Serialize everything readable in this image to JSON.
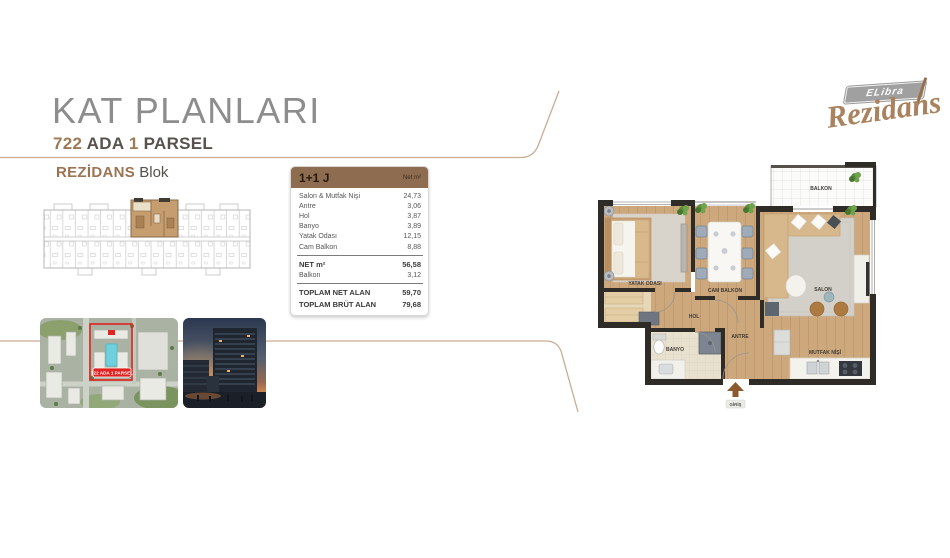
{
  "slide": {
    "title": "KAT PLANLARI",
    "parcel": {
      "num1": "722",
      "word1": "ADA",
      "num2": "1",
      "word2": "PARSEL"
    },
    "block": {
      "accent": "REZİDANS",
      "rest": "Blok"
    }
  },
  "logo": {
    "brand": "ELibra",
    "script": "Rezidans"
  },
  "unit_table": {
    "unit": "1+1 J",
    "unit_col": "Net m²",
    "rows": [
      {
        "label": "Salon & Mutfak Nişi",
        "value": "24,73"
      },
      {
        "label": "Antre",
        "value": "3,06"
      },
      {
        "label": "Hol",
        "value": "3,87"
      },
      {
        "label": "Banyo",
        "value": "3,89"
      },
      {
        "label": "Yatak Odası",
        "value": "12,15"
      },
      {
        "label": "Cam Balkon",
        "value": "8,88"
      }
    ],
    "net": {
      "label": "NET m²",
      "value": "56,58"
    },
    "balkon": {
      "label": "Balkon",
      "value": "3,12"
    },
    "totals": [
      {
        "label": "TOPLAM NET ALAN",
        "value": "59,70"
      },
      {
        "label": "TOPLAM BRÜT ALAN",
        "value": "79,68"
      }
    ]
  },
  "site_plan": {
    "badge": "722 ADA 1 PARSEL"
  },
  "floor_plan": {
    "rooms": {
      "balkon": "BALKON",
      "yatak_odasi": "YATAK ODASI",
      "cam_balkon": "CAM BALKON",
      "salon": "SALON",
      "hol": "HOL",
      "antre": "ANTRE",
      "banyo": "BANYO",
      "mutfak_nisi": "MUTFAK NİŞİ",
      "giris": "GİRİŞ"
    }
  },
  "colors": {
    "accent": "#9c7a56",
    "table_header": "#8d6c4f",
    "deco_line": "#c9ac92",
    "highlight_red": "#e02321"
  }
}
